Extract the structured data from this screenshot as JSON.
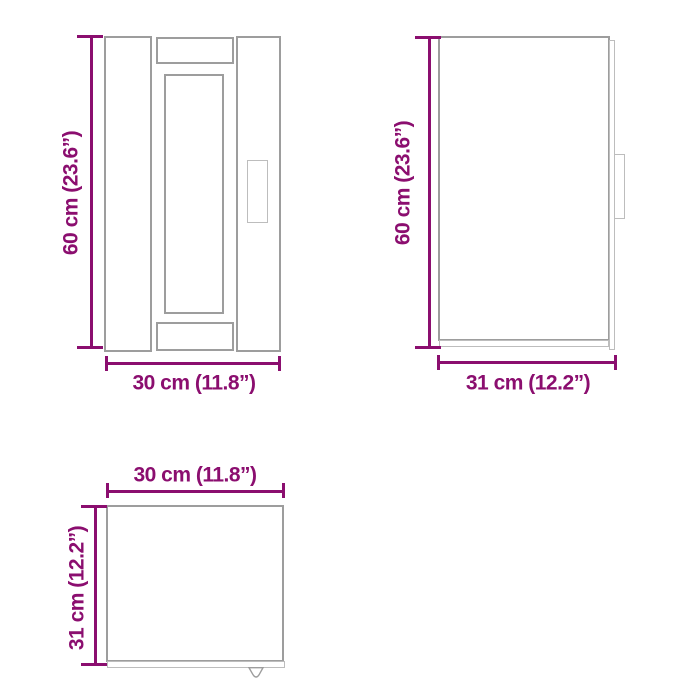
{
  "diagram": {
    "type": "furniture-dimension-diagram",
    "accent_color": "#8B0E6F",
    "outline_color": "#9D9D9D",
    "outline_light_color": "#BDBDBD",
    "views": {
      "front": {
        "height_label": "60 cm (23.6”)",
        "width_label": "30 cm (11.8”)"
      },
      "side": {
        "height_label": "60 cm (23.6”)",
        "width_label": "31 cm (12.2”)"
      },
      "top": {
        "width_label": "30 cm (11.8”)",
        "depth_label": "31 cm (12.2”)"
      }
    }
  }
}
